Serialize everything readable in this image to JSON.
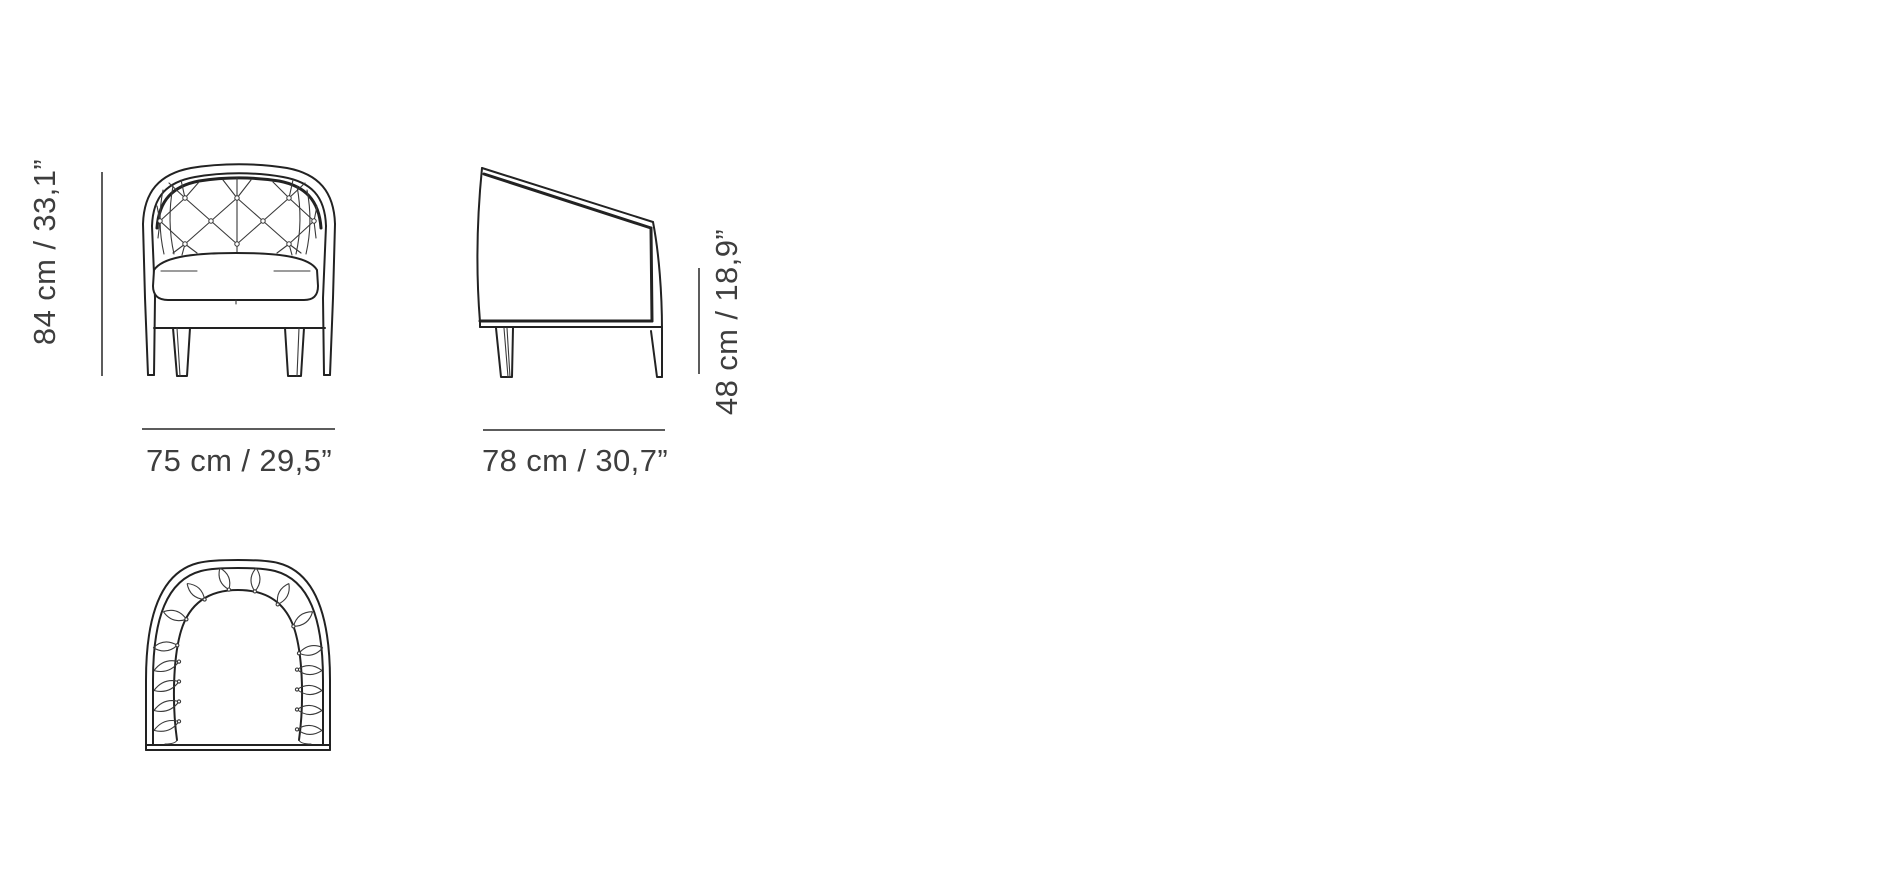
{
  "diagram": {
    "views": [
      {
        "id": "front-view"
      },
      {
        "id": "side-view"
      },
      {
        "id": "top-view"
      }
    ],
    "dimensions": {
      "height": "84 cm / 33,1”",
      "width": "75 cm / 29,5”",
      "depth": "78 cm / 30,7”",
      "seat_height": "48 cm / 18,9”"
    },
    "colors": {
      "background": "#ffffff",
      "drawing_line": "#222222",
      "dimension_line": "#5c5c5c",
      "label_text": "#3e3e3e"
    }
  }
}
